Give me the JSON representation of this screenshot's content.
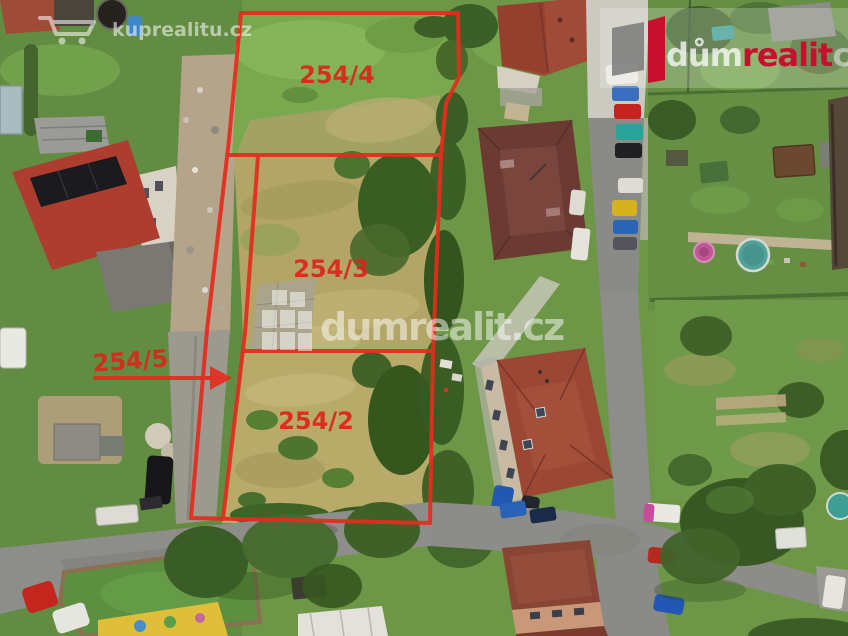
{
  "overlay": {
    "color": "#e62b1e",
    "parcel_labels": [
      {
        "id": "parcel-254-4",
        "text": "254/4"
      },
      {
        "id": "parcel-254-3",
        "text": "254/3"
      },
      {
        "id": "parcel-254-2",
        "text": "254/2"
      },
      {
        "id": "parcel-254-5",
        "text": "254/5"
      }
    ]
  },
  "watermark_top_left": {
    "icon": "shopping-cart-icon",
    "text": "kuprealitu.cz"
  },
  "watermark_center": {
    "icon": "building-blocks-icon",
    "text": "dumrealit.cz"
  },
  "logo_top_right": {
    "icon": "dumrealit-mark-icon",
    "text_light": "dům",
    "text_red": "realit",
    "text_clipped": "c",
    "red": "#c8102e"
  }
}
